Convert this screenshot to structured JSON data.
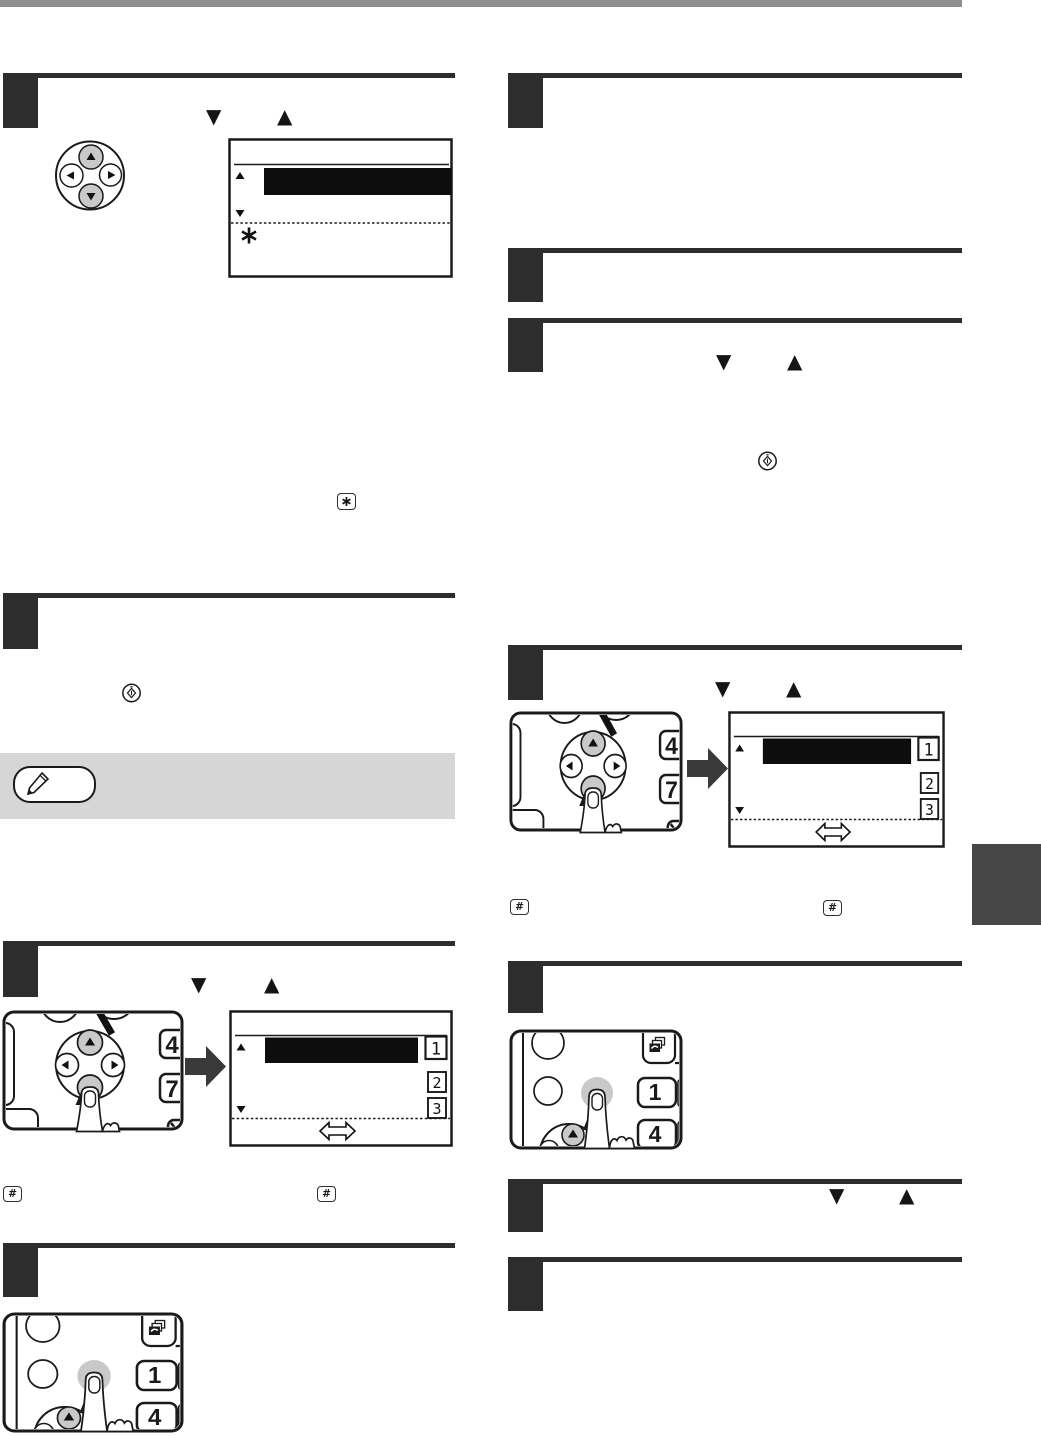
{
  "page": {
    "background": "#ffffff",
    "top_bar_color": "#8f8f8f",
    "step_block_color": "#2d2d2d",
    "chapter_tab_color": "#474747",
    "note_band_color": "#d6d6d6",
    "button_gray": "#c9c9c9",
    "arrow_color": "#3a3a3a",
    "line_color": "#1a1a1a"
  },
  "glyphs": {
    "triangle_down": "▼",
    "triangle_up": "▲",
    "hash_key": "#",
    "asterisk_key": "✱",
    "double_arrow": "⇔",
    "pencil_icon": "✎",
    "copies_icon": "⧉",
    "start_key": "◈"
  },
  "arrow_keypad": {
    "side_keys": [
      "4",
      "7"
    ]
  },
  "copy_keypad": {
    "side_keys": [
      "1",
      "4"
    ]
  },
  "lcd": {
    "list_item_numbers": [
      "1",
      "2",
      "3"
    ]
  }
}
